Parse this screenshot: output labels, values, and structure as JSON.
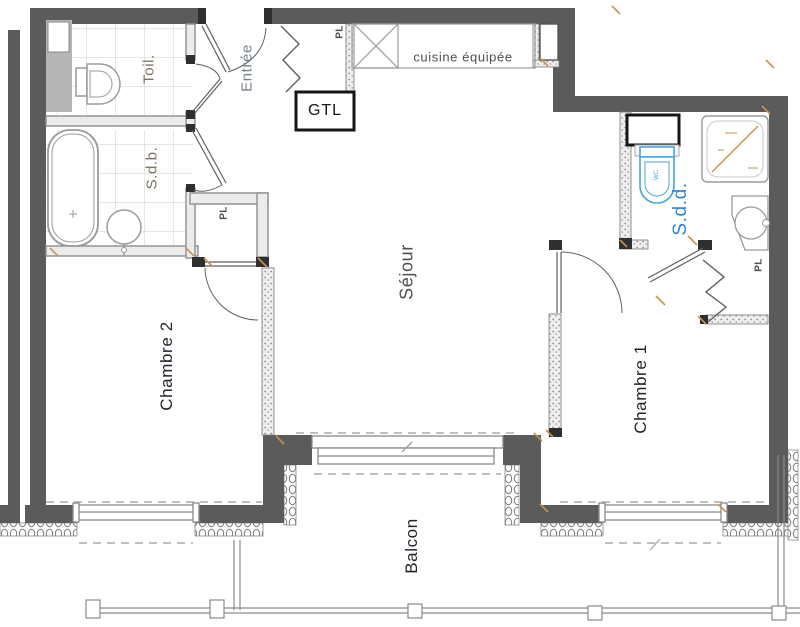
{
  "drawing_type": "apartment floor plan",
  "colors": {
    "wall": "#5b5b5b",
    "jamb": "#2f2f2f",
    "wall_light_stroke": "#8f8f8f",
    "wall_light_fill": "#ececec",
    "fixture": "#9a9a9a",
    "tile": "#cccccc",
    "ink": "#161616",
    "accent_blue": "#2e86d3",
    "accent_blue_light": "#45a6dc",
    "accent_tan": "#c3954f",
    "label_dark": "#20242c",
    "label_gray": "#4f4f4f",
    "label_taupe": "#7d7466",
    "label_entree": "#76808e",
    "dash": "#9a9a9a"
  },
  "rooms": {
    "entree": {
      "label": "Entrée"
    },
    "toilet": {
      "label": "Toil."
    },
    "bathroom": {
      "label": "S.d.b."
    },
    "kitchen": {
      "label": "cuisine équipée"
    },
    "gtl": {
      "label": "GTL"
    },
    "living": {
      "label": "Séjour"
    },
    "shower_room": {
      "label": "S.d.d."
    },
    "bedroom1": {
      "label": "Chambre 1"
    },
    "bedroom2": {
      "label": "Chambre 2"
    },
    "balcony": {
      "label": "Balcon"
    },
    "closet_entry": {
      "label": "PL"
    },
    "closet_bath": {
      "label": "PL"
    },
    "closet_hall": {
      "label": "PL"
    }
  },
  "fixtures": {
    "wc_small_label": "WC"
  }
}
